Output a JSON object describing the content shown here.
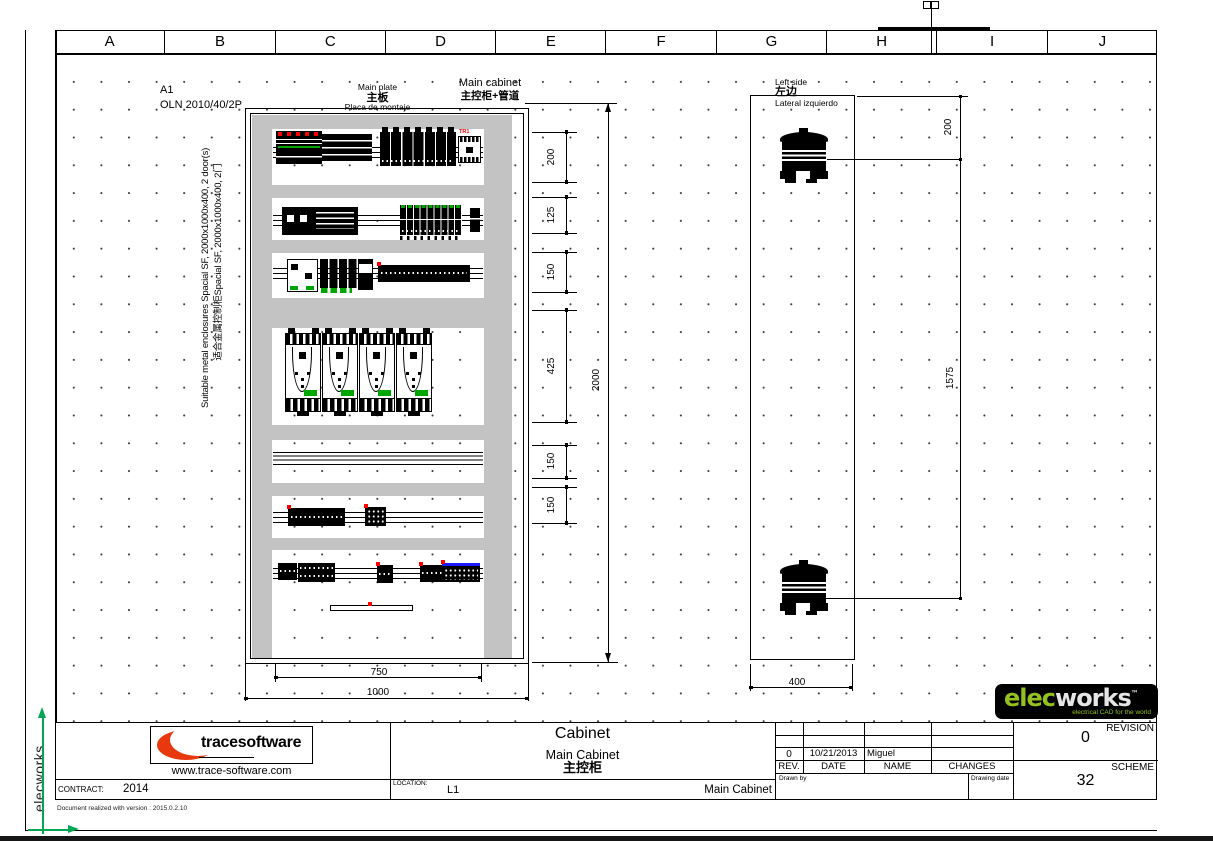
{
  "ruler": {
    "columns": [
      "A",
      "B",
      "C",
      "D",
      "E",
      "F",
      "G",
      "H",
      "I",
      "J"
    ]
  },
  "annotations": {
    "sheet_format": "A1",
    "reference": "OLN 2010/40/2P",
    "enclosure_note_en": "Suitable metal enclosures Spacial SF, 2000x1000x400, 2 door(s)",
    "enclosure_note_zh": "适合金属控制柜Spacial SF, 2000x1000x400, 2门"
  },
  "front_view": {
    "plate_label_en": "Main plate",
    "plate_label_zh": "主板",
    "plate_label_es": "Placa de montaje",
    "cabinet_label_en": "Main cabinet",
    "cabinet_label_zh": "主控柜+管道",
    "transformer_tag": "TR1",
    "dim_row_1": "200",
    "dim_row_2": "125",
    "dim_row_3": "150",
    "dim_row_4": "425",
    "dim_row_5": "150",
    "dim_row_6": "150",
    "dim_height": "2000",
    "dim_plate_width": "750",
    "dim_width": "1000"
  },
  "side_view": {
    "label_en": "Left side",
    "label_zh": "左边",
    "label_es": "Lateral izquierdo",
    "dim_top": "200",
    "dim_span": "1575",
    "dim_depth": "400"
  },
  "title_block": {
    "company": {
      "name_bold": "trace",
      "name_light": "software",
      "website": "www.trace-software.com"
    },
    "title": "Cabinet",
    "subtitle": "Main Cabinet",
    "subtitle_zh": "主控柜",
    "contract_label": "CONTRACT:",
    "contract_value": "2014",
    "location_label": "LOCATION:",
    "location_value": "L1",
    "cabinet_name": "Main Cabinet",
    "rev_table": {
      "entry": {
        "rev": "0",
        "date": "10/21/2013",
        "name": "Miguel",
        "changes": ""
      },
      "headers": {
        "rev": "REV.",
        "date": "DATE",
        "name": "NAME",
        "changes": "CHANGES"
      },
      "drawn_by_label": "Drawn by",
      "drawing_date_label": "Drawing date"
    },
    "revision_label": "REVISION",
    "revision_value": "0",
    "scheme_label": "SCHEME",
    "scheme_value": "32"
  },
  "branding": {
    "sidebar_text": "elecworks",
    "logo_elec": "elec",
    "logo_works": "works",
    "logo_tm": "™",
    "logo_tagline": "electrical CAD for the world"
  },
  "footer": {
    "version_note": "Document realized with version : 2015.0.2.10"
  },
  "colors": {
    "logo_red": "#e8380d",
    "elec_green": "#94c120",
    "component_green": "#00a600",
    "marker_red": "#ff0000",
    "terminal_blue": "#1a1aff",
    "axis_green": "#00a651",
    "rail_gray": "#c3c3c3"
  }
}
